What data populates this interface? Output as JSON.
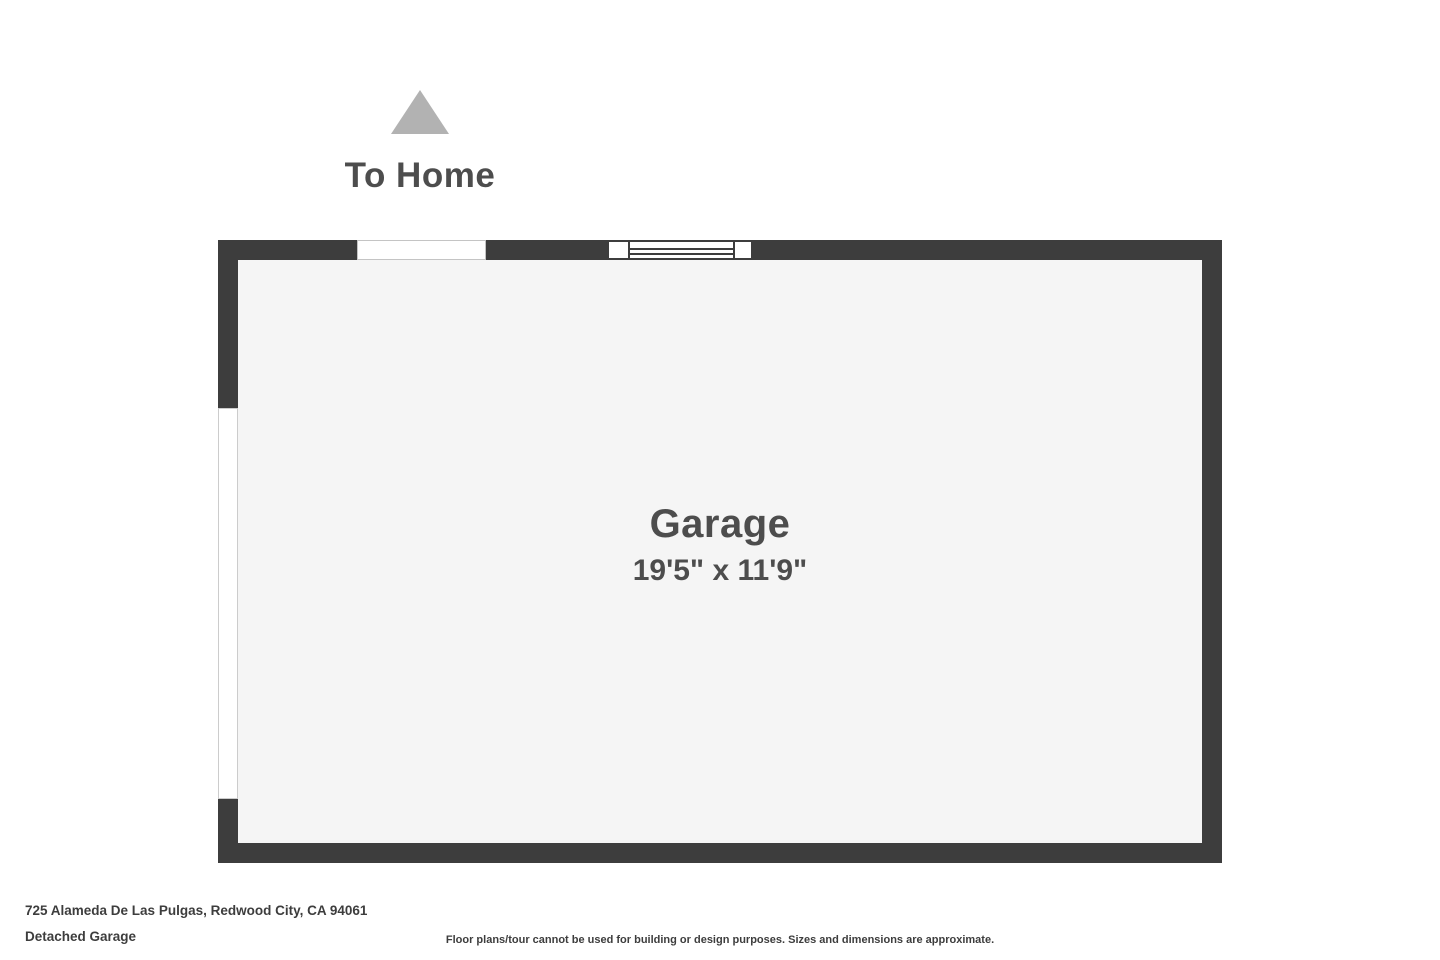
{
  "north_indicator": {
    "label": "To Home"
  },
  "floorplan": {
    "room": {
      "name": "Garage",
      "dimensions": "19'5\" x 11'9\""
    },
    "features": {
      "top_door_opening": "door-opening",
      "window": "window",
      "left_opening": "garage-door-opening"
    }
  },
  "footer": {
    "address": "725 Alameda De Las Pulgas, Redwood City, CA 94061",
    "plan_title": "Detached Garage",
    "disclaimer": "Floor plans/tour cannot be used for building or design purposes. Sizes and dimensions are approximate."
  },
  "colors": {
    "wall": "#3d3d3d",
    "floor": "#f5f5f5",
    "triangle": "#b2b2b2",
    "heading": "#4d4d4d",
    "text": "#3d3d3d"
  }
}
